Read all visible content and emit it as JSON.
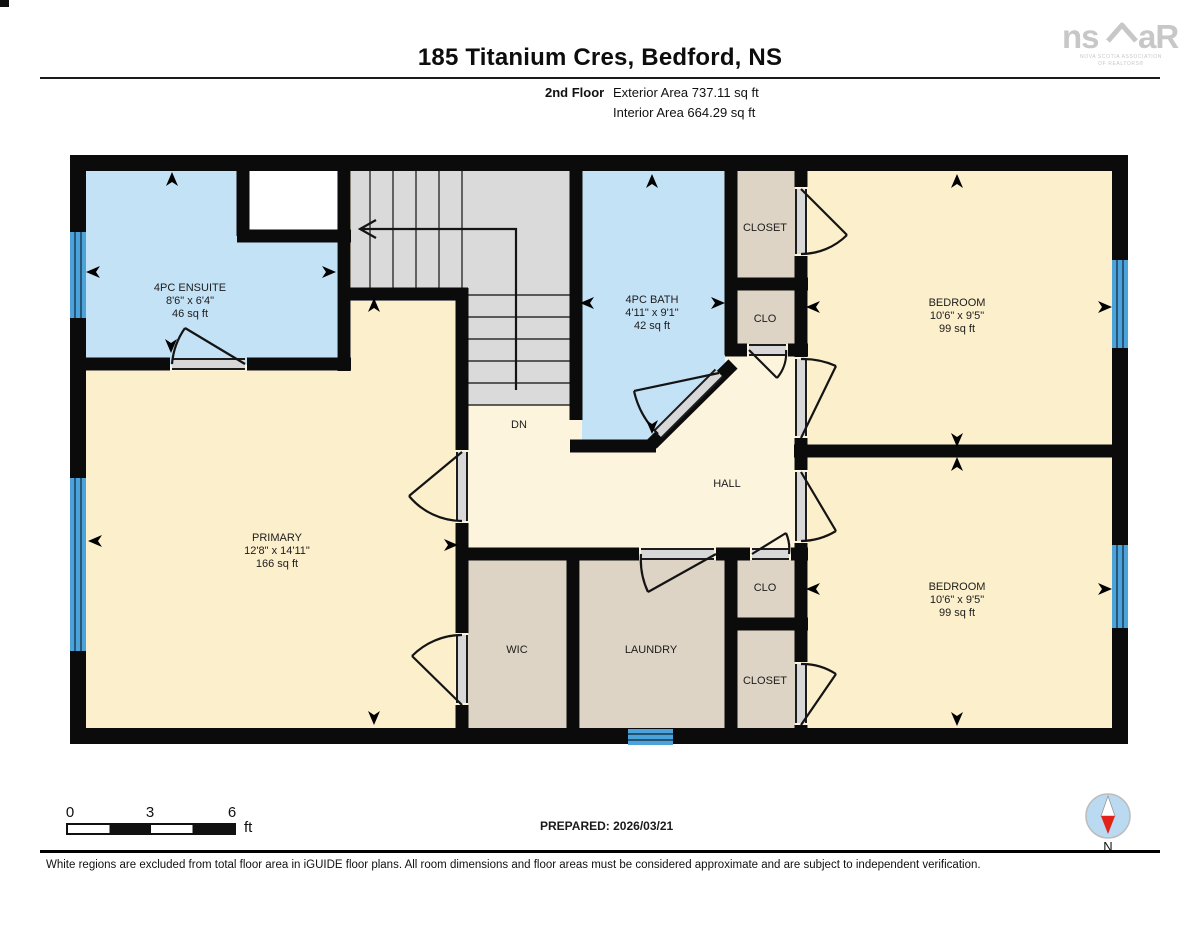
{
  "header": {
    "title": "185 Titanium Cres, Bedford, NS",
    "floor_label": "2nd Floor",
    "exterior_area": "Exterior Area 737.11 sq ft",
    "interior_area": "Interior Area 664.29 sq ft"
  },
  "logo": {
    "left": "ns",
    "right": "aR",
    "caption1": "NOVA SCOTIA ASSOCIATION",
    "caption2": "OF REALTORS®"
  },
  "rooms": {
    "ensuite": {
      "name": "4PC ENSUITE",
      "dims": "8'6\" x 6'4\"",
      "area": "46 sq ft"
    },
    "bath": {
      "name": "4PC BATH",
      "dims": "4'11\" x 9'1\"",
      "area": "42 sq ft"
    },
    "bedroom_top": {
      "name": "BEDROOM",
      "dims": "10'6\" x 9'5\"",
      "area": "99 sq ft"
    },
    "bedroom_bottom": {
      "name": "BEDROOM",
      "dims": "10'6\" x 9'5\"",
      "area": "99 sq ft"
    },
    "primary": {
      "name": "PRIMARY",
      "dims": "12'8\" x 14'11\"",
      "area": "166 sq ft"
    },
    "hall": {
      "label": "HALL"
    },
    "stairs": {
      "dn_label": "DN"
    },
    "closet_top": {
      "label": "CLOSET"
    },
    "clo_top": {
      "label": "CLO"
    },
    "clo_mid": {
      "label": "CLO"
    },
    "closet_bottom": {
      "label": "CLOSET"
    },
    "wic": {
      "label": "WIC"
    },
    "laundry": {
      "label": "LAUNDRY"
    }
  },
  "scale_bar": {
    "start": "0",
    "mid": "3",
    "end": "6",
    "unit": "ft"
  },
  "compass": {
    "label": "N"
  },
  "footer": {
    "prepared": "PREPARED: 2026/03/21",
    "disclaimer": "White regions are excluded from total floor area in iGUIDE floor plans. All room dimensions and floor areas must be considered approximate and are subject to independent verification."
  },
  "colors": {
    "wall": "#0b0b0b",
    "room_blue": "#c4e2f6",
    "room_cream": "#fcefcb",
    "hall_cream": "#fdf4dd",
    "room_tan": "#ddd4c5",
    "stairs_gray": "#dadada",
    "window_blue": "#4ba3da",
    "accent_red": "#e2231a",
    "compass_blue": "#badaf1",
    "logo_gray": "#c7c7c7"
  }
}
